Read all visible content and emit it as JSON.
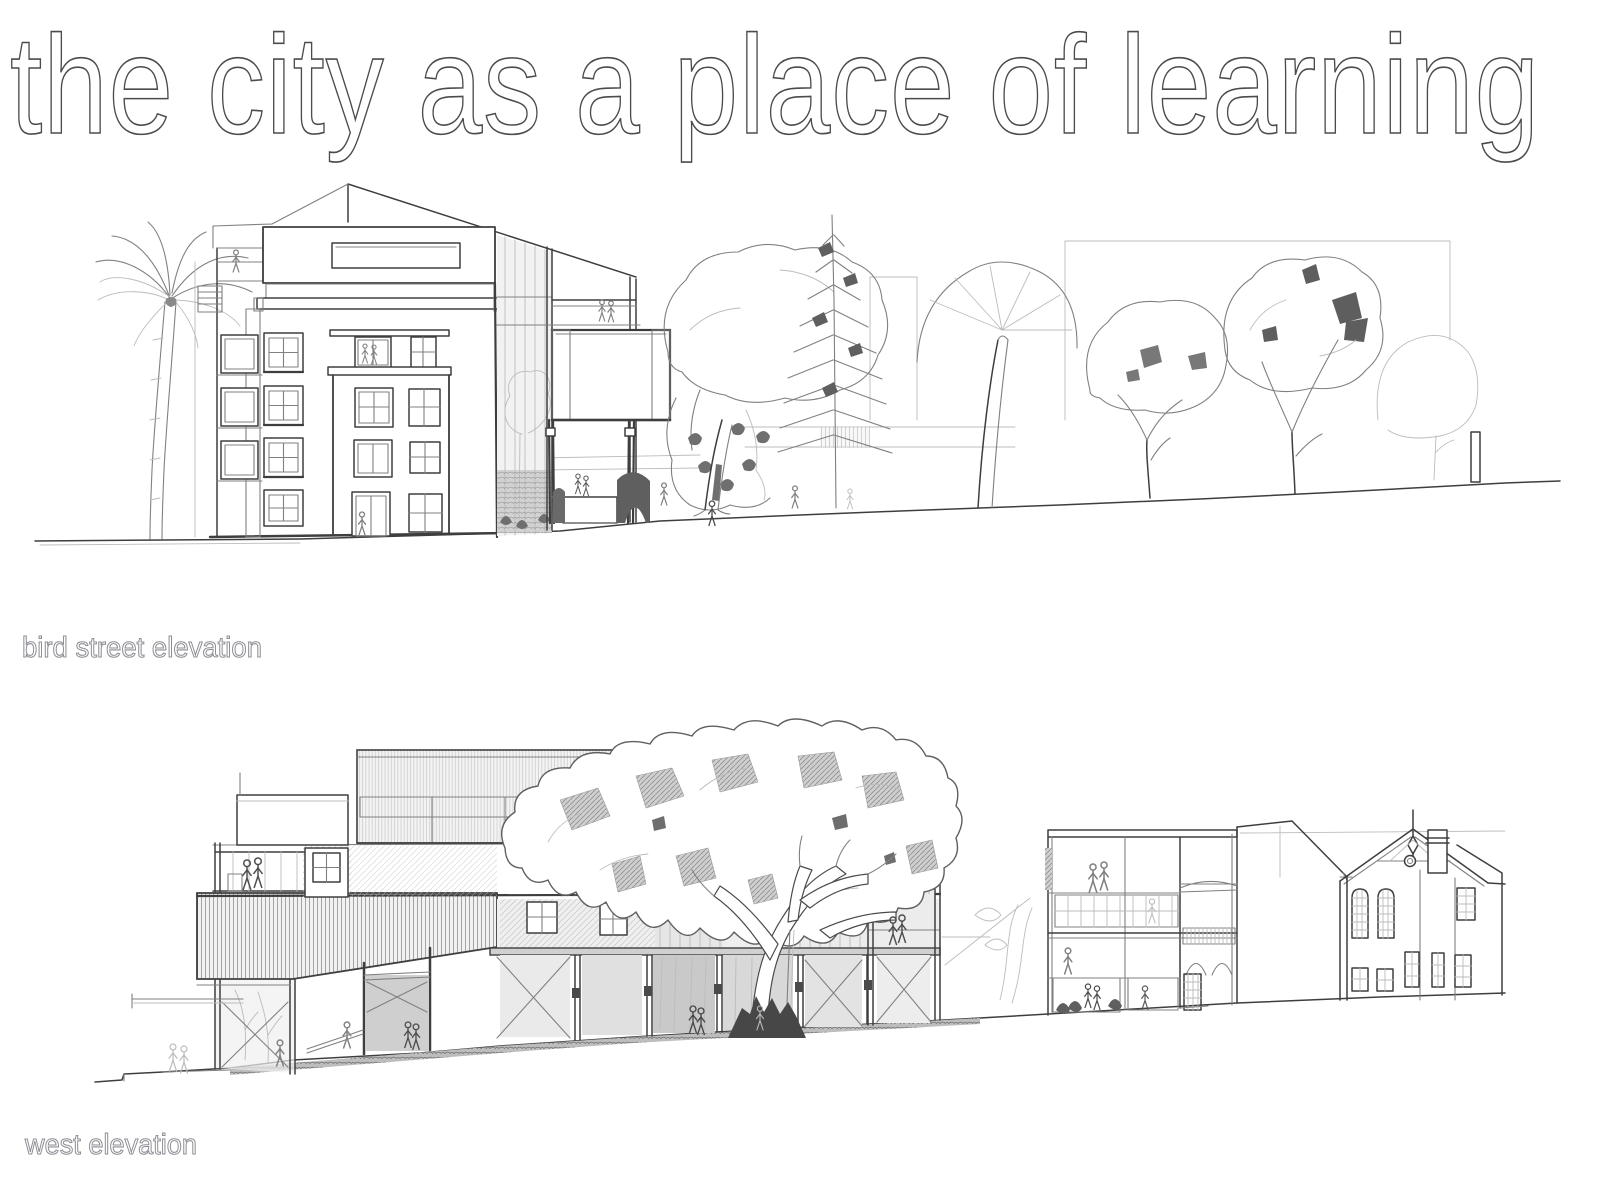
{
  "page": {
    "title": "the city as a place of learning"
  },
  "captions": {
    "bird_street": "bird street elevation",
    "west": "west elevation"
  },
  "colors": {
    "paper": "#ffffff",
    "ink-dark": "#3e3e3e",
    "ink-mid": "#808080",
    "ink-light": "#bcbcbc",
    "wash": "#e9e9e9",
    "title-outline": "#4b4b4b",
    "caption-outline": "#8d8d94"
  }
}
